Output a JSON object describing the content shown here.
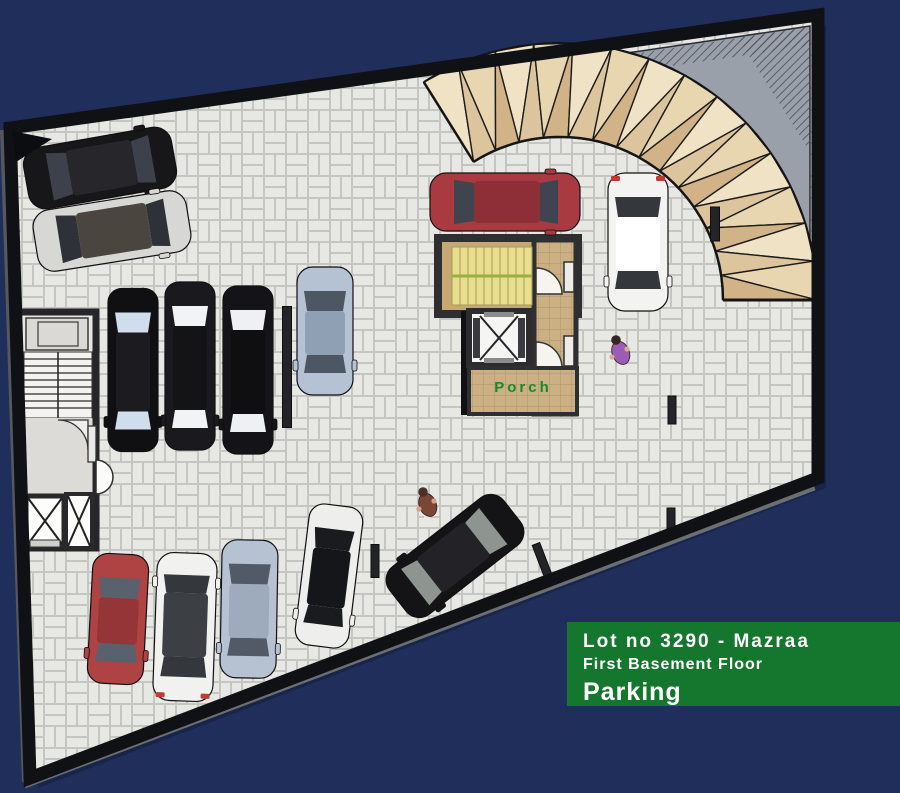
{
  "scene": {
    "bg": "#202e5c",
    "width": 900,
    "height": 793
  },
  "labels": {
    "porch": {
      "text": "Porch",
      "color": "#168a2c"
    },
    "info_box": {
      "bg": "#15772e",
      "text_color": "#ffffff",
      "line1": "Lot no 3290 - Mazraa",
      "line2": "First Basement Floor",
      "line3": "Parking"
    }
  },
  "colors": {
    "paving_brick": "#e7e7e4",
    "paving_joint": "#c5c5c2",
    "wall": "#101114",
    "wall_outer": "#6b6e73",
    "corner_fill": "#9aa0aa",
    "hatch_line": "#474c55",
    "ramp_facets": [
      "#f0e3c5",
      "#dcc49c",
      "#e8d6b0",
      "#d2b388"
    ],
    "ramp_edge": "#151515",
    "core_floor": "#c8a872",
    "stair_yellow": "#e9de8d",
    "stair_line": "#b0a763",
    "stair_green": "#97b23c",
    "tile_tan": "#cbb083",
    "tile_line": "#b2946a",
    "left_core_floor": "#e8e6e2",
    "stub": "#222428"
  },
  "cars": [
    {
      "name": "black-car-top-left",
      "x": 100,
      "y": 168,
      "rot": 80,
      "w": 62,
      "l": 150,
      "body": "#17171a",
      "roof": "#26262b",
      "glass": "#3c414b"
    },
    {
      "name": "silver-car-top-left",
      "x": 112,
      "y": 231,
      "rot": 81,
      "w": 62,
      "l": 155,
      "body": "#d7d7d4",
      "roof": "#4a453f",
      "glass": "#2e3238"
    },
    {
      "name": "black-car-row-1",
      "x": 133,
      "y": 370,
      "rot": 180,
      "w": 50,
      "l": 163,
      "body": "#101013",
      "roof": "#1c1c20",
      "glass": "#cfdded"
    },
    {
      "name": "black-car-row-2",
      "x": 190,
      "y": 366,
      "rot": 180,
      "w": 50,
      "l": 168,
      "body": "#1a1a1e",
      "roof": "#141417",
      "glass": "#f2f3f5"
    },
    {
      "name": "black-car-row-3",
      "x": 248,
      "y": 370,
      "rot": 180,
      "w": 50,
      "l": 168,
      "body": "#141418",
      "roof": "#0f0f12",
      "glass": "#eef0f3"
    },
    {
      "name": "blue-gray-car-upper",
      "x": 325,
      "y": 331,
      "rot": 180,
      "w": 56,
      "l": 128,
      "body": "#b5c2d3",
      "roof": "#8fa0b5",
      "glass": "#4d5663"
    },
    {
      "name": "red-car-top",
      "x": 505,
      "y": 202,
      "rot": 90,
      "w": 58,
      "l": 150,
      "body": "#a93a42",
      "roof": "#8e2f37",
      "glass": "#3f444e"
    },
    {
      "name": "white-suv-top",
      "x": 638,
      "y": 242,
      "rot": 180,
      "w": 60,
      "l": 138,
      "body": "#f3f3f1",
      "roof": "#ffffff",
      "glass": "#34383d",
      "accent": "#c03a30"
    },
    {
      "name": "red-car-bottom",
      "x": 118,
      "y": 619,
      "rot": 183,
      "w": 56,
      "l": 130,
      "body": "#af4242",
      "roof": "#963538",
      "glass": "#59616c"
    },
    {
      "name": "white-van-bottom",
      "x": 185,
      "y": 627,
      "rot": 2,
      "w": 60,
      "l": 148,
      "body": "#f1f1ef",
      "roof": "#3c3f43",
      "glass": "#34373b",
      "accent": "#c23b31"
    },
    {
      "name": "blue-gray-car-bottom",
      "x": 249,
      "y": 609,
      "rot": 181,
      "w": 56,
      "l": 138,
      "body": "#b6c2d2",
      "roof": "#9dabbd",
      "glass": "#515a66"
    },
    {
      "name": "white-sports-car-bottom",
      "x": 329,
      "y": 576,
      "rot": 187,
      "w": 54,
      "l": 142,
      "body": "#eeefed",
      "roof": "#15161a",
      "glass": "#1a1b1f"
    },
    {
      "name": "black-suv-bottom",
      "x": 455,
      "y": 556,
      "rot": 232,
      "w": 60,
      "l": 145,
      "body": "#141416",
      "roof": "#232327",
      "glass": "#8e948f"
    }
  ],
  "people": [
    {
      "name": "person-walking-lower",
      "x": 427,
      "y": 503,
      "body": "#7b4636",
      "head": "#4a3028",
      "skin": "#d2a489"
    },
    {
      "name": "person-walking-right",
      "x": 620,
      "y": 351,
      "body": "#9a5cb4",
      "head": "#352620",
      "skin": "#d8ab8e"
    }
  ],
  "stubs": [
    {
      "x": 287,
      "y": 367,
      "w": 9,
      "h": 121,
      "rot": 0
    },
    {
      "x": 375,
      "y": 561,
      "w": 8,
      "h": 33,
      "rot": 0
    },
    {
      "x": 544,
      "y": 565,
      "w": 8,
      "h": 45,
      "rot": -21
    },
    {
      "x": 672,
      "y": 410,
      "w": 8,
      "h": 28,
      "rot": 0
    },
    {
      "x": 671,
      "y": 520,
      "w": 8,
      "h": 24,
      "rot": 0
    },
    {
      "x": 715,
      "y": 224,
      "w": 9,
      "h": 34,
      "rot": 0
    }
  ]
}
